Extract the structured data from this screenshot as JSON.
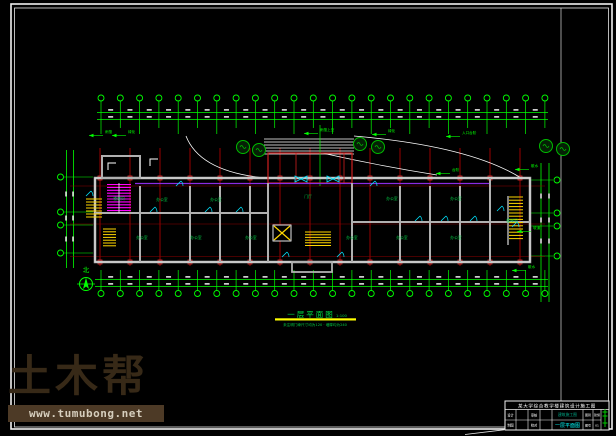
{
  "app": {
    "background": "#000000"
  },
  "colors": {
    "frame": "#f0f0f0",
    "dim_green": "#00ff00",
    "label_green": "#00cc44",
    "grid_red": "#c00000",
    "marker_red": "#e03030",
    "wall_gray": "#b0b0b0",
    "wall_white": "#ffffff",
    "stair_magenta": "#ff00ff",
    "corridor_purple": "#8a2be2",
    "door_cyan": "#00e5ff",
    "stair_yellow": "#ffd700",
    "underline_yellow": "#ffff00",
    "tree_green": "#00bb00",
    "watermark_brown": "#372917",
    "watermark_bar": "#4d3a26",
    "titleblock_teal": "#00aa88",
    "titleblock_cyan": "#00ffff"
  },
  "watermark": {
    "logo_text": "土木帮",
    "site_url": "www.tumubong.net"
  },
  "drawing": {
    "title": "一层平面图",
    "title_scale": "1:100",
    "note": "未注明门垛尺寸均为120 · 墙厚均为240",
    "north_label": "北",
    "room_labels": [
      {
        "text": "楼梯间",
        "x": 119,
        "y": 200
      },
      {
        "text": "办公室",
        "x": 162,
        "y": 201
      },
      {
        "text": "办公室",
        "x": 216,
        "y": 201
      },
      {
        "text": "门厅",
        "x": 308,
        "y": 198
      },
      {
        "text": "办公室",
        "x": 392,
        "y": 200
      },
      {
        "text": "办公室",
        "x": 456,
        "y": 200
      },
      {
        "text": "办公室",
        "x": 142,
        "y": 239
      },
      {
        "text": "办公室",
        "x": 196,
        "y": 239
      },
      {
        "text": "办公室",
        "x": 251,
        "y": 239
      },
      {
        "text": "办公室",
        "x": 352,
        "y": 239
      },
      {
        "text": "办公室",
        "x": 402,
        "y": 239
      },
      {
        "text": "办公室",
        "x": 456,
        "y": 239
      },
      {
        "text": "楼梯间",
        "x": 512,
        "y": 222
      }
    ],
    "annotations": [
      {
        "text": "雨篷",
        "x": 105,
        "y": 133
      },
      {
        "text": "绿化",
        "x": 128,
        "y": 133
      },
      {
        "text": "雨篷上空",
        "x": 320,
        "y": 131
      },
      {
        "text": "绿化",
        "x": 388,
        "y": 132
      },
      {
        "text": "入口台阶",
        "x": 462,
        "y": 134
      },
      {
        "text": "台阶",
        "x": 452,
        "y": 171
      },
      {
        "text": "散水",
        "x": 531,
        "y": 167
      },
      {
        "text": "坡道",
        "x": 533,
        "y": 229
      },
      {
        "text": "散水",
        "x": 528,
        "y": 268
      }
    ]
  },
  "title_block": {
    "header": "某大学综合教学楼建筑设计施工图",
    "cell_design": "设计",
    "cell_check": "审核",
    "cell_draw": "制图",
    "cell_proof": "校对",
    "project": "建筑施工图",
    "drawing_name": "一层平面图",
    "cell_type_label": "图别",
    "cell_type": "建施",
    "cell_no_label": "图号",
    "cell_no": "01"
  }
}
